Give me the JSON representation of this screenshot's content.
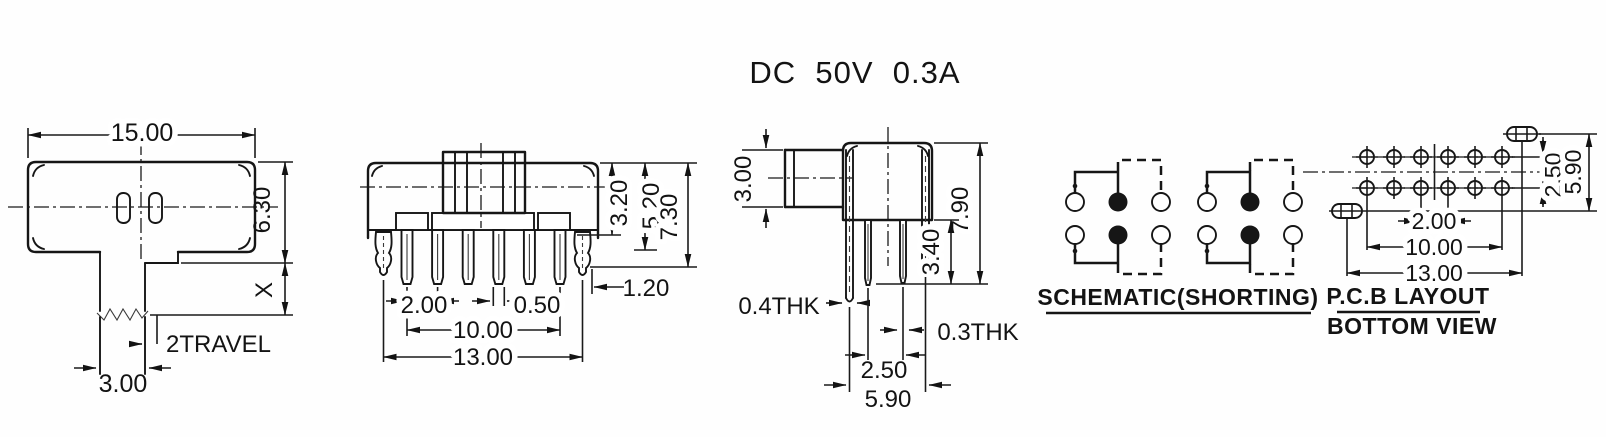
{
  "title": "DC  50V  0.3A",
  "top_view": {
    "dim_width": "15.00",
    "dim_height": "6.30",
    "dim_x": "X",
    "label_travel": "2TRAVEL",
    "dim_knob_width": "3.00"
  },
  "front_view": {
    "dim_pin_pitch": "2.00",
    "dim_pin_width": "0.50",
    "dim_pin_span": "10.00",
    "dim_leg_span": "13.00",
    "dim_h1": "3.20",
    "dim_h2": "5.20",
    "dim_h3": "7.30",
    "dim_leg_offset": "1.20"
  },
  "side_view": {
    "dim_knob_height": "3.00",
    "dim_total_height": "7.90",
    "dim_pin_length": "3.40",
    "label_leg_thickness": "0.4THK",
    "label_pin_thickness": "0.3THK",
    "dim_row_pitch": "2.50",
    "dim_leg_pitch": "5.90"
  },
  "schematic": {
    "label": "SCHEMATIC(SHORTING)"
  },
  "pcb": {
    "label_line1": "P.C.B LAYOUT",
    "label_line2": "BOTTOM VIEW",
    "dim_pad_pitch": "2.00",
    "dim_pad_span": "10.00",
    "dim_slot_span": "13.00",
    "dim_row_pitch": "2.50",
    "dim_slot_row_pitch": "5.90"
  }
}
